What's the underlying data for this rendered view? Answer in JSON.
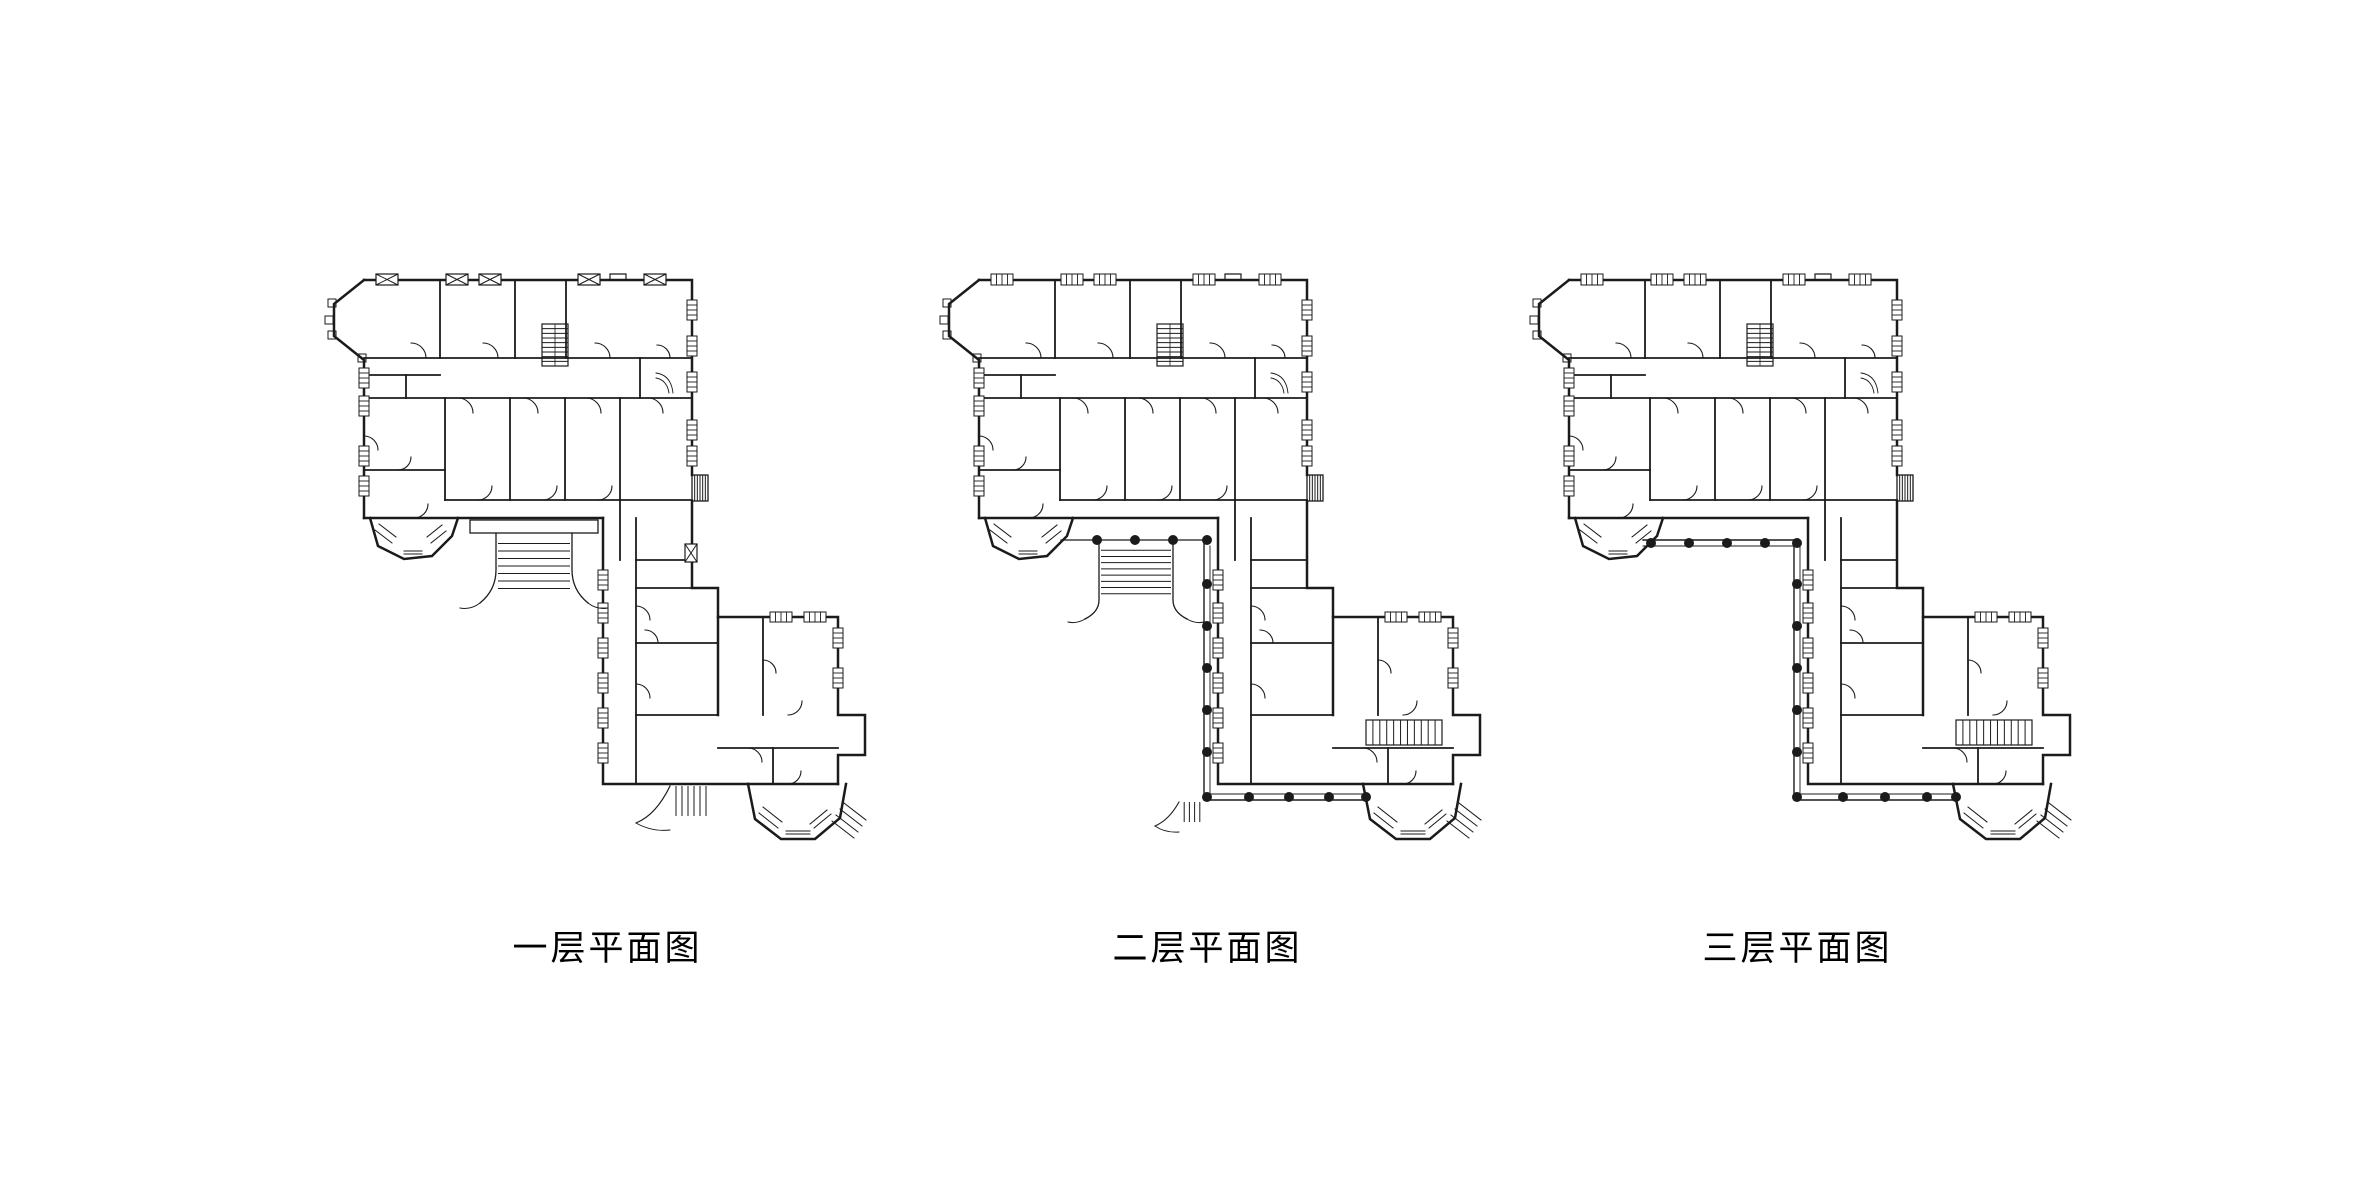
{
  "background_color": "#ffffff",
  "floor_plans": {
    "line_color": "#1b1b1b",
    "common": [
      [
        "P",
        "M46,10 H374 V205",
        2.5
      ],
      [
        "P",
        "M292,10 v-6 h16 v6",
        1.2
      ],
      [
        "P",
        "M374,231 V318 H400 V445",
        2.5
      ],
      [
        "P",
        "M400,347 H520 V445 H547 V485 H520 V514",
        2.5
      ],
      [
        "P",
        "M46,10 L16,34 V66 L46,90 V248",
        2.5
      ],
      [
        "P",
        "M46,248 H285",
        2.5
      ],
      [
        "P",
        "M285,248 V514 H430",
        2.5
      ],
      [
        "P",
        "M430,514 H520",
        2.5
      ],
      [
        "P",
        "M430,514 L437,549 L463,569 L497,569 L522,548 L528,514",
        2.5
      ],
      [
        "P",
        "M52,248 L60,276 L86,289 L114,286 L134,266 L140,248",
        2.5
      ],
      [
        "R",
        374,
        205,
        16,
        26,
        1.3
      ],
      [
        "S",
        374,
        205,
        16,
        26,
        5,
        "v"
      ],
      [
        "R",
        10,
        29,
        8,
        8,
        1
      ],
      [
        "R",
        7,
        46,
        8,
        8,
        1
      ],
      [
        "R",
        10,
        61,
        8,
        8,
        1
      ],
      [
        "R",
        40,
        84,
        8,
        8,
        1
      ],
      [
        "P",
        "M46,88 H374",
        1.8
      ],
      [
        "P",
        "M122,10 V88",
        1.8
      ],
      [
        "P",
        "M197,10 V88",
        1.8
      ],
      [
        "P",
        "M248,10 V88",
        1.8
      ],
      [
        "P",
        "M322,88 V128",
        1.8
      ],
      [
        "P",
        "M46,128 H374",
        1.8
      ],
      [
        "P",
        "M46,105 H122",
        1.8
      ],
      [
        "P",
        "M88,105 V128",
        1.8
      ],
      [
        "P",
        "M127,128 V230",
        1.8
      ],
      [
        "P",
        "M192,128 V230",
        1.8
      ],
      [
        "P",
        "M247,128 V230",
        1.8
      ],
      [
        "P",
        "M302,128 V230",
        1.8
      ],
      [
        "P",
        "M127,230 H374",
        1.8
      ],
      [
        "P",
        "M46,200 H127",
        1.8
      ],
      [
        "P",
        "M302,230 V290",
        1.8
      ],
      [
        "P",
        "M318,248 V514",
        1.8
      ],
      [
        "P",
        "M318,290 H374",
        1.8
      ],
      [
        "P",
        "M318,318 H400",
        1.8
      ],
      [
        "P",
        "M318,373 H400",
        1.8
      ],
      [
        "P",
        "M318,445 H400",
        1.8
      ],
      [
        "P",
        "M400,478 H520",
        1.8
      ],
      [
        "P",
        "M445,347 V445",
        1.8
      ],
      [
        "P",
        "M455,478 V514",
        1.8
      ],
      [
        "R",
        224,
        54,
        26,
        42,
        1.2
      ],
      [
        "S",
        224,
        54,
        26,
        42,
        8,
        "h"
      ],
      [
        "P",
        "M237,54 V96",
        0.8
      ],
      [
        "P",
        "M338,103 q15,2 17,20 M338,108 q11,2 13,15",
        0.9
      ],
      [
        "W",
        41,
        98,
        10,
        20
      ],
      [
        "W",
        41,
        126,
        10,
        20
      ],
      [
        "W",
        41,
        176,
        10,
        20
      ],
      [
        "W",
        41,
        206,
        10,
        20
      ],
      [
        "W",
        369,
        30,
        10,
        20
      ],
      [
        "W",
        369,
        66,
        10,
        20
      ],
      [
        "W",
        369,
        102,
        10,
        20
      ],
      [
        "W",
        369,
        150,
        10,
        20
      ],
      [
        "W",
        369,
        176,
        10,
        20
      ],
      [
        "W",
        280,
        300,
        10,
        20
      ],
      [
        "W",
        280,
        333,
        10,
        20
      ],
      [
        "W",
        280,
        368,
        10,
        20
      ],
      [
        "W",
        280,
        403,
        10,
        20
      ],
      [
        "W",
        280,
        438,
        10,
        20
      ],
      [
        "W",
        280,
        473,
        10,
        20
      ],
      [
        "W",
        515,
        358,
        10,
        20
      ],
      [
        "W",
        515,
        398,
        10,
        20
      ],
      [
        "W",
        452,
        342,
        22,
        10
      ],
      [
        "W",
        486,
        342,
        22,
        10
      ],
      [
        "P",
        "M57,260 l17,13 M61,254 l17,13",
        1
      ],
      [
        "P",
        "M113,273 l15,-12 M109,267 l15,-12",
        1
      ],
      [
        "P",
        "M86,281 h18 M86,284 h18",
        1
      ],
      [
        "P",
        "M441,543 l19,15 M445,537 l19,15",
        1
      ],
      [
        "P",
        "M468,561 h24 M468,564 h24",
        1
      ],
      [
        "P",
        "M496,558 l17,-14 M492,554 l17,-14",
        1
      ],
      [
        "P",
        "M514,551 l22,17 M518,545 l22,17 M522,539 l22,17 M526,533 l22,17",
        1
      ],
      [
        "P",
        "M108,88 a15,15 0 0 0 -15,-15",
        1.1
      ],
      [
        "P",
        "M180,88 a15,15 0 0 0 -15,-15",
        1.1
      ],
      [
        "P",
        "M292,88 a15,15 0 0 0 -15,-15",
        1.1
      ],
      [
        "P",
        "M352,88 a13,13 0 0 0 -13,-13",
        1.1
      ],
      [
        "P",
        "M140,128 a15,15 0 0 1 15,15",
        1.1
      ],
      [
        "P",
        "M205,128 a15,15 0 0 1 15,15",
        1.1
      ],
      [
        "P",
        "M268,128 a15,15 0 0 1 15,15",
        1.1
      ],
      [
        "P",
        "M330,128 a15,15 0 0 1 15,15",
        1.1
      ],
      [
        "P",
        "M46,166 a14,14 0 0 1 14,14",
        1.1
      ],
      [
        "P",
        "M160,230 a14,14 0 0 0 14,-14",
        1.1
      ],
      [
        "P",
        "M225,230 a14,14 0 0 0 14,-14",
        1.1
      ],
      [
        "P",
        "M280,230 a14,14 0 0 0 14,-14",
        1.1
      ],
      [
        "P",
        "M80,200 a13,13 0 0 0 13,-13",
        1.1
      ],
      [
        "P",
        "M96,248 a14,14 0 0 0 14,-14",
        1.1
      ],
      [
        "P",
        "M318,336 a14,14 0 0 1 14,14",
        1.1
      ],
      [
        "P",
        "M318,414 a14,14 0 0 1 14,14",
        1.1
      ],
      [
        "P",
        "M340,373 a13,13 0 0 0 -13,-13",
        1.1
      ],
      [
        "P",
        "M470,445 a14,14 0 0 0 14,-14",
        1.1
      ],
      [
        "P",
        "M430,478 a14,14 0 0 1 14,14",
        1.1
      ],
      [
        "P",
        "M470,514 a13,13 0 0 0 13,-13",
        1.1
      ],
      [
        "P",
        "M445,390 a13,13 0 0 1 13,13",
        1.1
      ]
    ],
    "plans": [
      {
        "label": "一层平面图",
        "shapes": [
          [
            "X",
            58,
            4,
            22,
            11
          ],
          [
            "X",
            128,
            4,
            22,
            11
          ],
          [
            "X",
            161,
            4,
            22,
            11
          ],
          [
            "X",
            260,
            4,
            22,
            11
          ],
          [
            "X",
            326,
            4,
            22,
            11
          ],
          [
            "X",
            367,
            274,
            12,
            18
          ],
          [
            "R",
            152,
            250,
            128,
            13,
            1.3
          ],
          [
            "P",
            "M178,263 V300 Q178,320 162,333",
            1.3
          ],
          [
            "P",
            "M254,263 V300 Q254,320 270,333",
            1.3
          ],
          [
            "P",
            "M162,333 q-9,7 -20,5",
            1
          ],
          [
            "P",
            "M270,333 q9,7 20,5",
            1
          ],
          [
            "S",
            180,
            266,
            72,
            60,
            7,
            "h"
          ],
          [
            "S",
            352,
            516,
            42,
            30,
            6,
            "v"
          ],
          [
            "P",
            "M352,516 Q338,545 318,553",
            1.2
          ],
          [
            "P",
            "M318,553 q16,9 34,7",
            0.9
          ]
        ]
      },
      {
        "label": "二层平面图",
        "shapes": [
          [
            "W",
            58,
            4,
            22,
            11
          ],
          [
            "W",
            128,
            4,
            22,
            11
          ],
          [
            "W",
            161,
            4,
            22,
            11
          ],
          [
            "W",
            260,
            4,
            22,
            11
          ],
          [
            "W",
            326,
            4,
            22,
            11
          ],
          [
            "P",
            "M128,270 H277",
            1.3
          ],
          [
            "P",
            "M166,272 V330 Q166,342 152,349",
            1.3
          ],
          [
            "P",
            "M240,272 V330 Q240,342 254,349",
            1.3
          ],
          [
            "P",
            "M152,349 q-8,5 -17,3",
            1
          ],
          [
            "P",
            "M254,349 q8,5 17,3",
            1
          ],
          [
            "S",
            168,
            274,
            70,
            56,
            8,
            "h"
          ],
          [
            "P",
            "M271,270 V530 H434",
            1.4
          ],
          [
            "P",
            "M277,276 V524 H434",
            0.9
          ],
          [
            "C",
            164,
            270,
            5
          ],
          [
            "C",
            202,
            270,
            5
          ],
          [
            "C",
            240,
            270,
            5
          ],
          [
            "C",
            274,
            270,
            5
          ],
          [
            "C",
            274,
            314,
            5
          ],
          [
            "C",
            274,
            356,
            5
          ],
          [
            "C",
            274,
            398,
            5
          ],
          [
            "C",
            274,
            440,
            5
          ],
          [
            "C",
            274,
            482,
            5
          ],
          [
            "C",
            274,
            527,
            5
          ],
          [
            "C",
            316,
            527,
            5
          ],
          [
            "C",
            356,
            527,
            5
          ],
          [
            "C",
            396,
            527,
            5
          ],
          [
            "C",
            433,
            527,
            5
          ],
          [
            "S",
            246,
            532,
            26,
            20,
            4,
            "v"
          ],
          [
            "P",
            "M246,532 Q236,550 222,556",
            1.1
          ],
          [
            "P",
            "M222,556 q10,7 24,6",
            0.9
          ],
          [
            "R",
            433,
            450,
            76,
            25,
            1.2
          ],
          [
            "S",
            433,
            450,
            76,
            25,
            10,
            "v"
          ]
        ]
      },
      {
        "label": "三层平面图",
        "shapes": [
          [
            "W",
            58,
            4,
            22,
            11
          ],
          [
            "W",
            128,
            4,
            22,
            11
          ],
          [
            "W",
            161,
            4,
            22,
            11
          ],
          [
            "W",
            260,
            4,
            22,
            11
          ],
          [
            "W",
            326,
            4,
            22,
            11
          ],
          [
            "P",
            "M120,270 H271",
            1.4
          ],
          [
            "P",
            "M120,276 H277",
            0.9
          ],
          [
            "P",
            "M271,270 V530 H434",
            1.4
          ],
          [
            "P",
            "M277,276 V524 H434",
            0.9
          ],
          [
            "C",
            128,
            273,
            5
          ],
          [
            "C",
            166,
            273,
            5
          ],
          [
            "C",
            204,
            273,
            5
          ],
          [
            "C",
            242,
            273,
            5
          ],
          [
            "C",
            274,
            273,
            5
          ],
          [
            "C",
            274,
            314,
            5
          ],
          [
            "C",
            274,
            356,
            5
          ],
          [
            "C",
            274,
            398,
            5
          ],
          [
            "C",
            274,
            440,
            5
          ],
          [
            "C",
            274,
            482,
            5
          ],
          [
            "C",
            274,
            527,
            5
          ],
          [
            "C",
            320,
            527,
            5
          ],
          [
            "C",
            362,
            527,
            5
          ],
          [
            "C",
            404,
            527,
            5
          ],
          [
            "C",
            433,
            527,
            5
          ],
          [
            "R",
            433,
            450,
            76,
            25,
            1.2
          ],
          [
            "S",
            433,
            450,
            76,
            25,
            10,
            "v"
          ]
        ]
      }
    ]
  }
}
